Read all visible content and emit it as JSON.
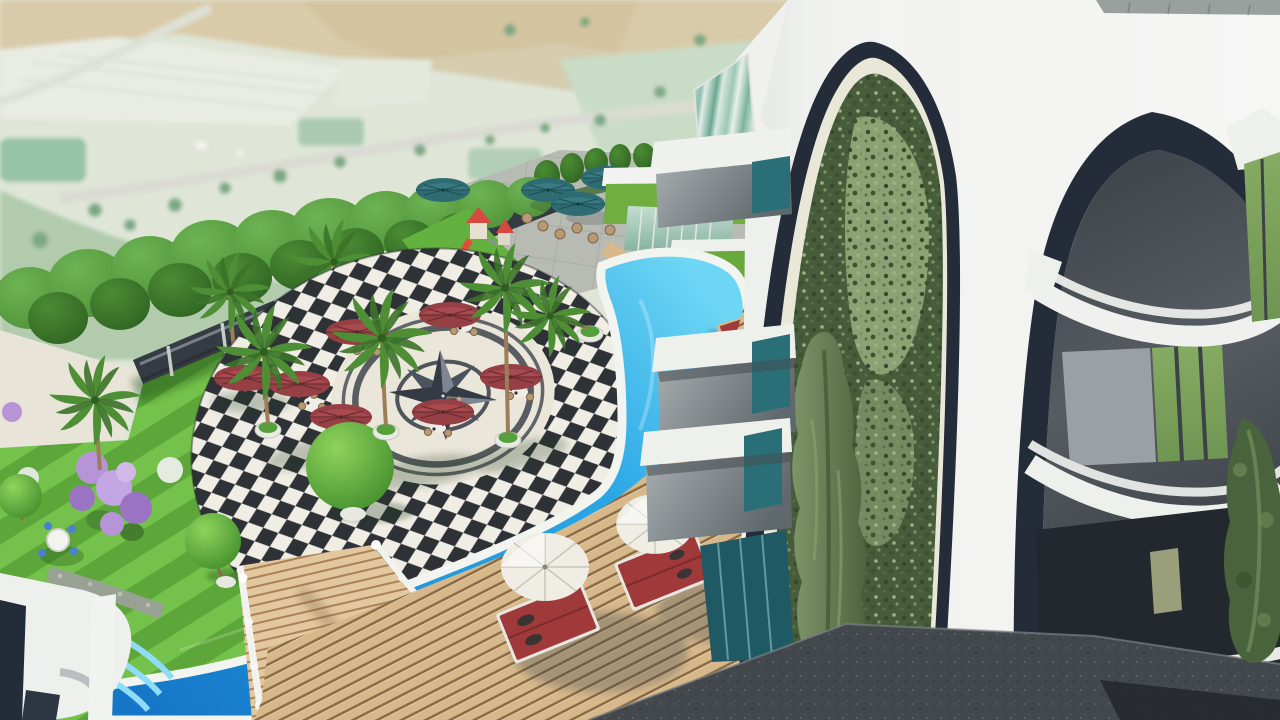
{
  "scene": {
    "type": "3d-architectural-render",
    "view": "aerial three-quarter view",
    "subject": "Modern white residential complex with two tall arches (one filled with a living ivy wall and cypress tree), an S-curved swimming pool, a black-and-white checkered plaza with a compass rose, palm garden, lawn, playground, cafe terrace and wooden sun deck overlooking farmland",
    "inventory": {
      "red_cafe_umbrellas": 7,
      "teal_terrace_umbrellas": 4,
      "white_beach_umbrellas": 2,
      "sun_loungers": 3,
      "palm_trees": 8,
      "topiary_balls": 3,
      "building_arches": 2,
      "green_wall_arches": 1,
      "pool_float": 1,
      "playground": 1,
      "compass_rose": 1
    }
  },
  "palette": {
    "land_base": "#dfe6d8",
    "land_beige": "#d8c9a6",
    "land_field": "#e9ece3",
    "land_mint": "#c9dcc6",
    "land_sage": "#a9c5a4",
    "land_road": "#dadcd3",
    "lawn_light": "#74c24b",
    "lawn_dark": "#5ca63a",
    "lawn_shadow": "#2e6b22",
    "sand": "#e8e4d7",
    "gravel": "#99a195",
    "lilac": "#b793d8",
    "lilac_deep": "#9a74c2",
    "checker_dark": "#2e3237",
    "checker_light": "#f0ede4",
    "plaza_stone": "#ebe6da",
    "compass_dark": "#343b44",
    "pool_shallow": "#6cd6f4",
    "pool_mid": "#2aa6e5",
    "pool_deep": "#1677c8",
    "pool_rim": "#f2f4ef",
    "deck_tan": "#d6b88b",
    "deck_gap": "#8a6a44",
    "bridge_tan": "#e3c89f",
    "paving_dark": "#43484d",
    "terrace_stone": "#b8bbb3",
    "fence_dark": "#343b42",
    "tree_green": "#4f9338",
    "tree_dark": "#2f6423",
    "palm_green": "#4e8f36",
    "topiary_green": "#59a838",
    "conifer": "#49633c",
    "ivy_dark": "#475c3a",
    "ivy_light": "#93a87a",
    "cypress": "#6e8659",
    "building_white": "#f2f3f1",
    "navy": "#232c38",
    "cream": "#e9e8d8",
    "facade_gray": "#565c62",
    "balcony_floor": "#9aa0a3",
    "window_green": "#6f9553",
    "teal_glass": "#2a6e77",
    "grass_roof": "#6fae3f",
    "umbrella_red": "#963f45",
    "umbrella_white": "#f0ede5",
    "umbrella_teal": "#2e6b72",
    "lounger_red": "#a03a3a",
    "wicker": "#b69a76"
  }
}
